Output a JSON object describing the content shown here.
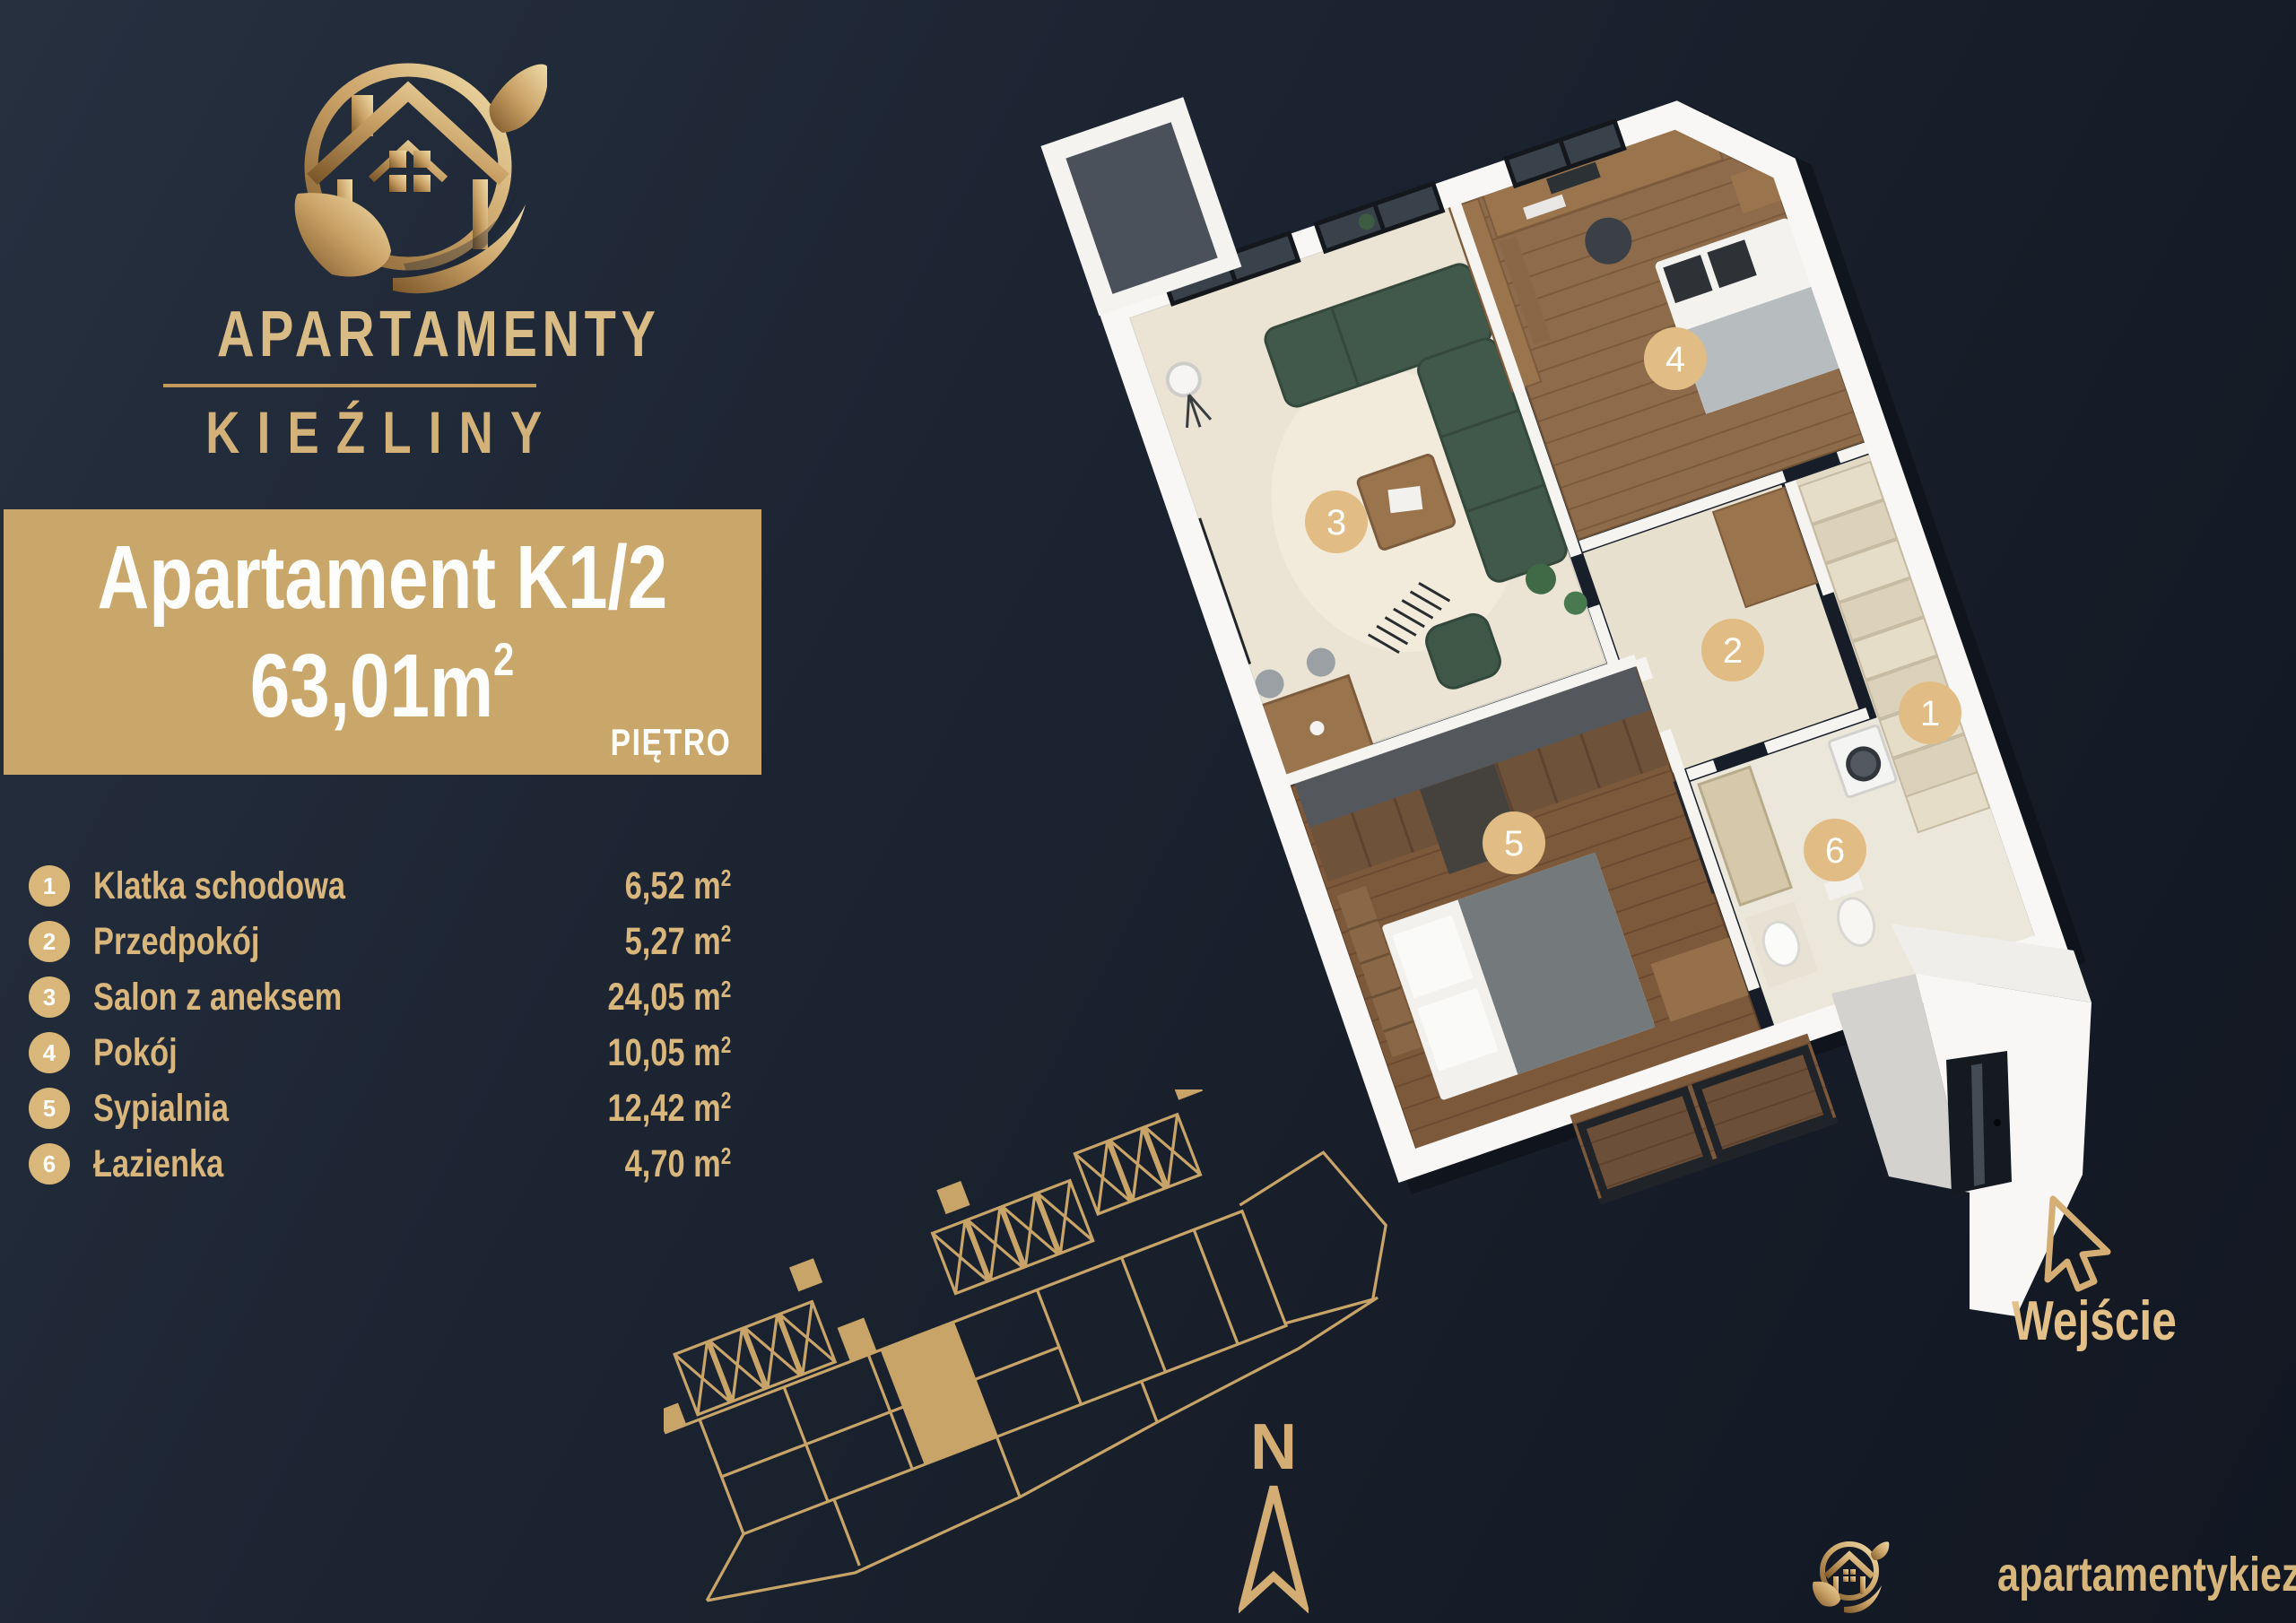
{
  "brand": {
    "line1": "APARTAMENTY",
    "line2": "KIEŹLINY"
  },
  "unit": {
    "title": "Apartament K1/2",
    "area_value": "63,01m",
    "area_sup": "2",
    "floor": "PIĘTRO"
  },
  "rooms": [
    {
      "no": "1",
      "name": "Klatka schodowa",
      "area": "6,52 m",
      "sup": "2"
    },
    {
      "no": "2",
      "name": "Przedpokój",
      "area": "5,27 m",
      "sup": "2"
    },
    {
      "no": "3",
      "name": "Salon z aneksem",
      "area": "24,05 m",
      "sup": "2"
    },
    {
      "no": "4",
      "name": "Pokój",
      "area": "10,05 m",
      "sup": "2"
    },
    {
      "no": "5",
      "name": "Sypialnia",
      "area": "12,42 m",
      "sup": "2"
    },
    {
      "no": "6",
      "name": "Łazienka",
      "area": "4,70 m",
      "sup": "2"
    }
  ],
  "compass": {
    "label": "N"
  },
  "entrance": {
    "label": "Wejście"
  },
  "footer": {
    "website": "apartamentykiezliny.pl"
  },
  "colors": {
    "background": "#1b2330",
    "panel": "#c9a76b",
    "gold_text": "#d8b67c",
    "brand_gold": "#d9bc85",
    "marker_fill": "#e1bd85",
    "line_gold": "#c8a468",
    "white": "#ffffff"
  }
}
